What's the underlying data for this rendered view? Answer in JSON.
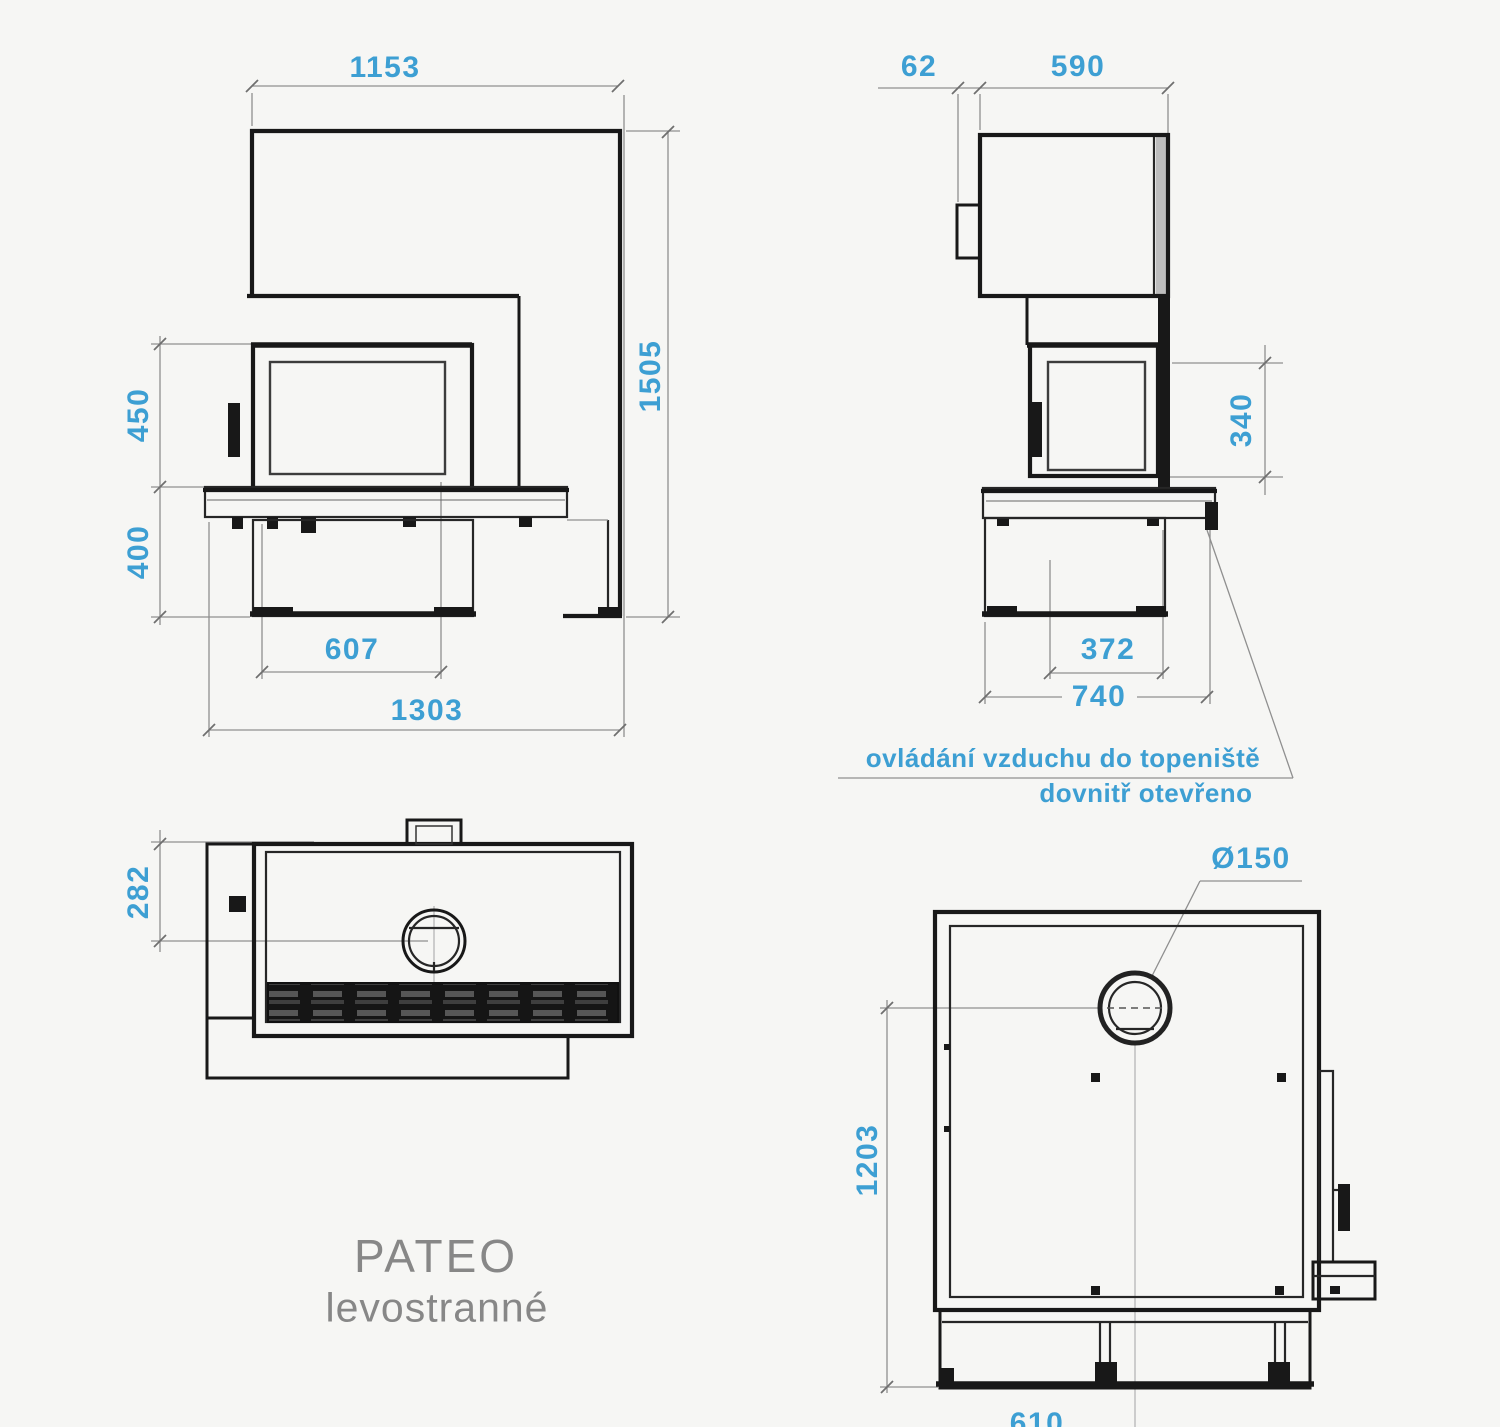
{
  "product": {
    "name": "PATEO",
    "variant": "levostranné"
  },
  "annotation": {
    "line1": "ovládání vzduchu do topeniště",
    "line2": "dovnitř otevřeno"
  },
  "colors": {
    "dimension_text": "#3d9fd3",
    "drawing_line": "#181818",
    "dimension_line": "#8f8f8f",
    "title_text": "#878787",
    "background": "#f6f6f4"
  },
  "views": {
    "front": {
      "label": "front view",
      "dims": {
        "width_top": "1153",
        "height_total": "1505",
        "door_height": "450",
        "base_height": "400",
        "door_width": "607",
        "width_total": "1303"
      }
    },
    "side": {
      "label": "side view",
      "dims": {
        "handle_depth": "62",
        "depth_top": "590",
        "door_side_height": "340",
        "inner_depth": "372",
        "depth_total": "740"
      }
    },
    "top": {
      "label": "top view",
      "dims": {
        "flue_center_offset": "282"
      }
    },
    "plan": {
      "label": "plan view",
      "dims": {
        "flue_diameter": "Ø150",
        "depth_total": "1203",
        "width_bottom": "610"
      }
    }
  }
}
